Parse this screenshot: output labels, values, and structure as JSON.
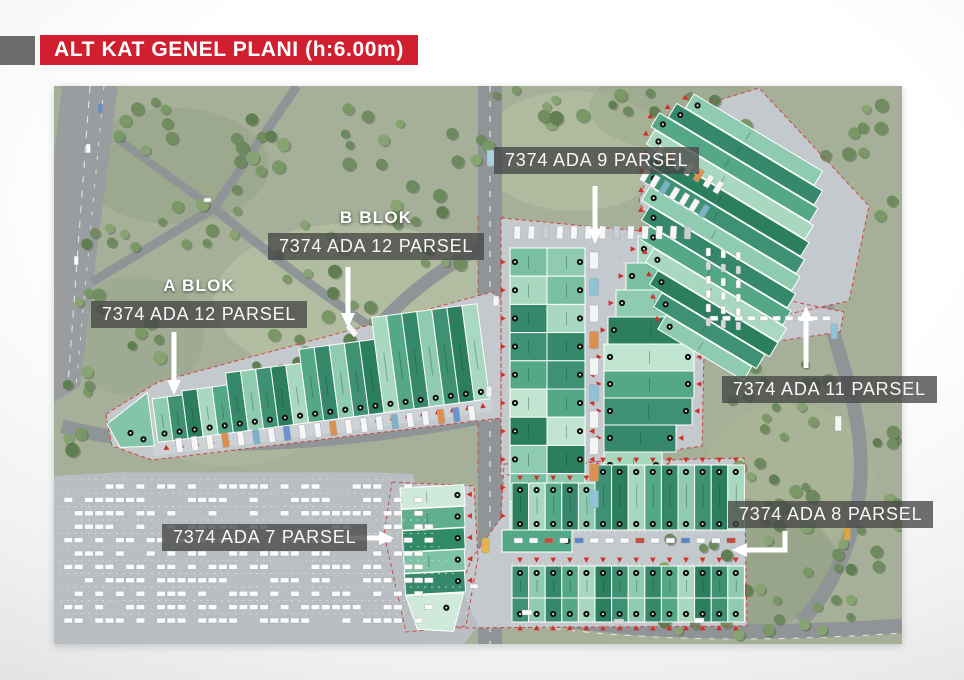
{
  "header": {
    "title": "ALT KAT GENEL PLANI (h:6.00m)"
  },
  "map": {
    "callouts": [
      {
        "id": "ada9",
        "block_label": "",
        "parcel_label": "7374 ADA 9 PARSEL",
        "arrow_direction": "down"
      },
      {
        "id": "b-blok",
        "block_label": "B BLOK",
        "parcel_label": "7374 ADA 12 PARSEL",
        "arrow_direction": "down"
      },
      {
        "id": "a-blok",
        "block_label": "A BLOK",
        "parcel_label": "7374 ADA 12 PARSEL",
        "arrow_direction": "down"
      },
      {
        "id": "ada11",
        "block_label": "",
        "parcel_label": "7374 ADA 11 PARSEL",
        "arrow_direction": "up"
      },
      {
        "id": "ada7",
        "block_label": "",
        "parcel_label": "7374 ADA 7 PARSEL",
        "arrow_direction": "right"
      },
      {
        "id": "ada8",
        "block_label": "",
        "parcel_label": "7374 ADA 8 PARSEL",
        "arrow_direction": "down-left"
      }
    ],
    "colors": {
      "banner_red": "#d01f2f",
      "header_accent_gray": "#6b6b6b",
      "callout_box": "rgba(70,70,70,0.78)",
      "callout_text": "#ffffff",
      "arrow_white": "#ffffff",
      "grass": "#a6b098",
      "tree_green": "#6c8a5e",
      "road_gray": "#8f9496",
      "parking_gray": "#c4c9cd",
      "building_greens": [
        "#8fcbb0",
        "#3e9273",
        "#2c7f5e",
        "#a8d8bf",
        "#55a887",
        "#35896a"
      ],
      "unit_marker_black": "#141414",
      "entry_marker_red": "#d03028",
      "parcel_boundary_red": "#cf3a3a"
    }
  }
}
